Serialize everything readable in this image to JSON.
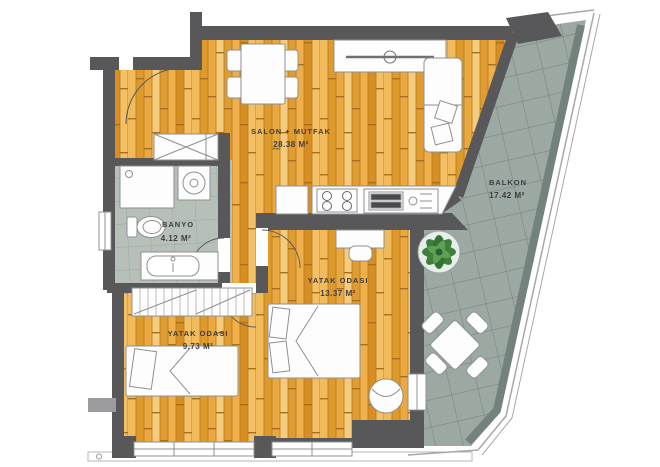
{
  "plan_title": "apartment-floor-plan",
  "rooms": [
    {
      "name": "SALON + MUTFAK",
      "area": "28.38 M²"
    },
    {
      "name": "BALKON",
      "area": "17.42 M²"
    },
    {
      "name": "BANYO",
      "area": "4.12 M²"
    },
    {
      "name": "YATAK ODASI",
      "area": "13.37 M²"
    },
    {
      "name": "YATAK ODASI",
      "area": "9.73 M²"
    }
  ],
  "colors": {
    "wall": "#58585A",
    "wood_floor": "#E8A641",
    "balcony_tile": "#9CA9A3",
    "bath_tile": "#B6C0B9",
    "furniture_outline": "#8F9092",
    "plant_green": "#3F7F3C",
    "label_text": "#3D3D40"
  }
}
